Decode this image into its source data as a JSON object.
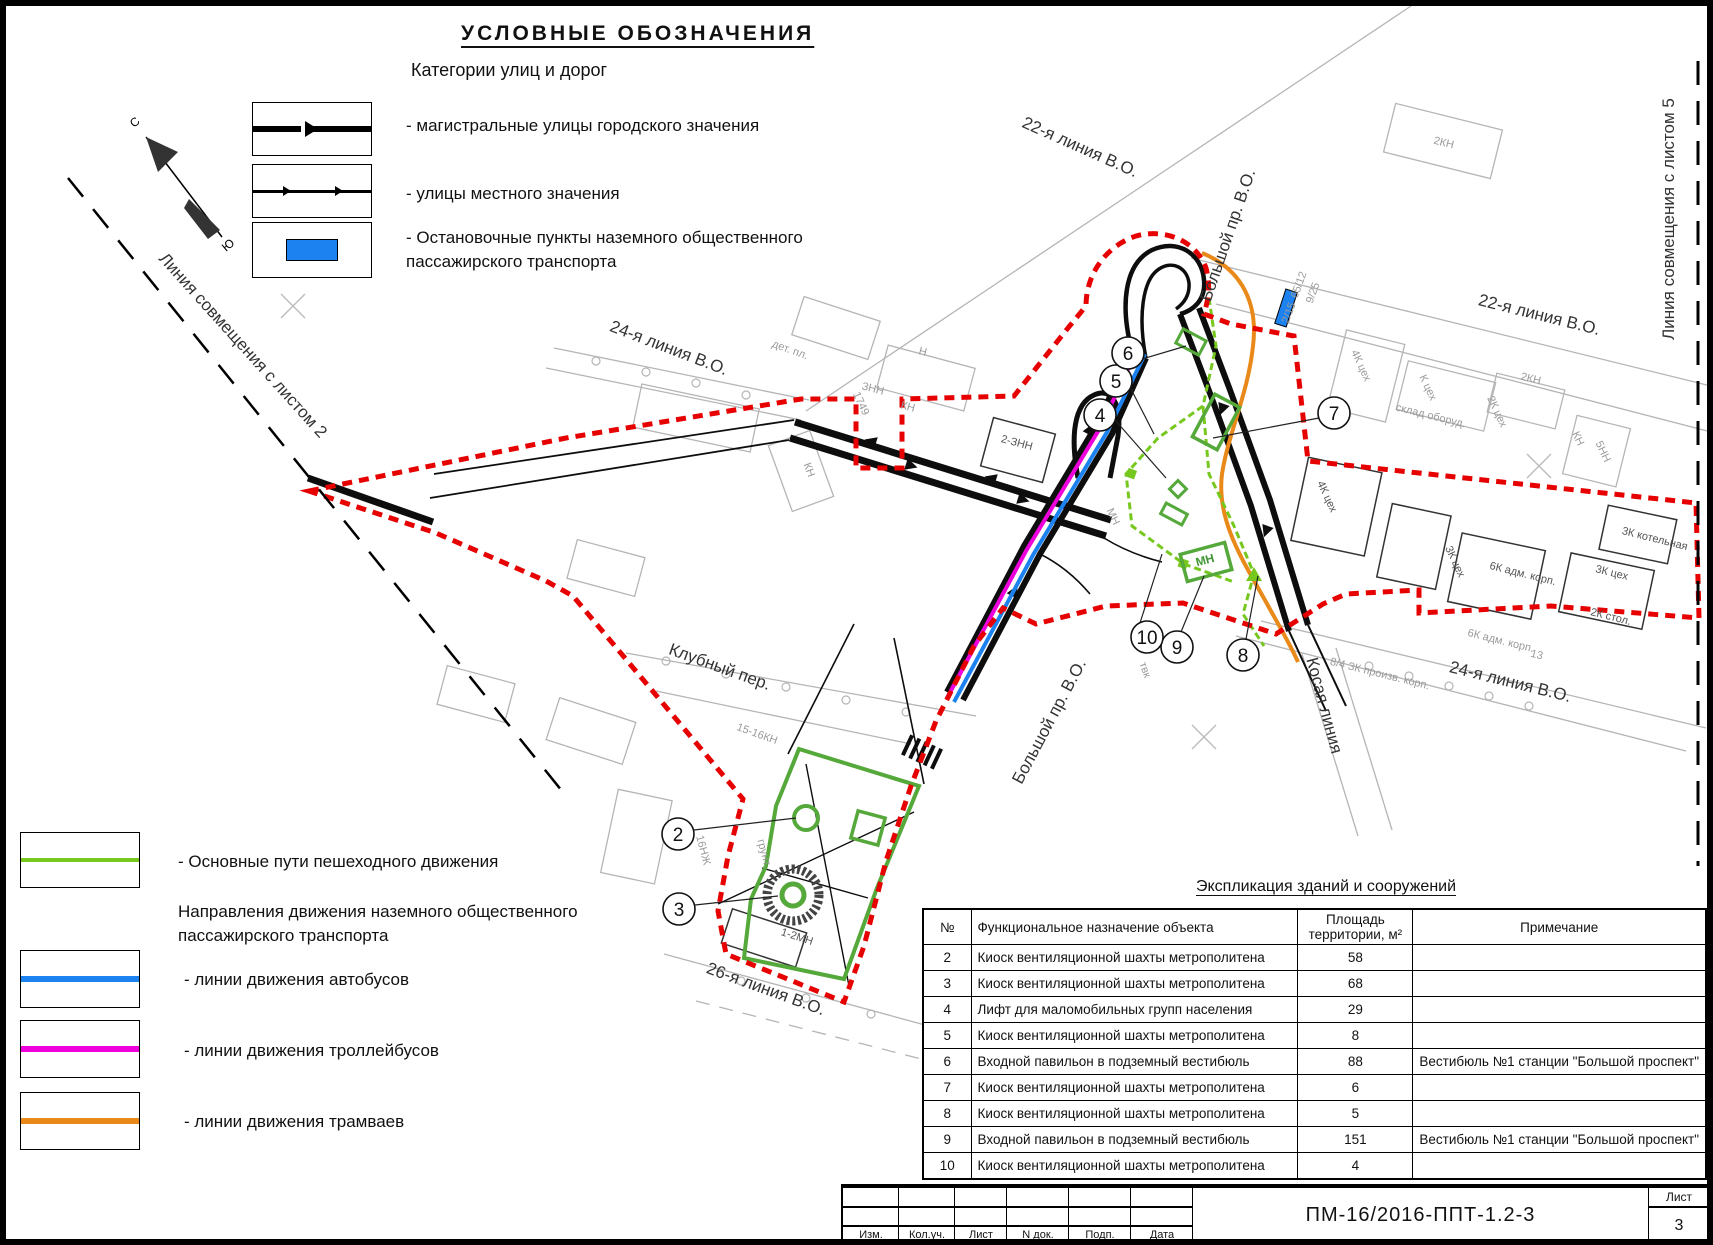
{
  "legend_top": {
    "title": "УСЛОВНЫЕ  ОБОЗНАЧЕНИЯ",
    "subtitle": "Категории улиц и дорог",
    "item_arterial": "-  магистральные улицы городского значения",
    "item_local": "-  улицы местного значения",
    "item_stops": "-  Остановочные пункты наземного общественного пассажирского транспорта"
  },
  "legend_bottom": {
    "pedestrian": "-  Основные пути пешеходного движения",
    "transport_header": "Направления движения наземного  общественного пассажирского транспорта",
    "buses": "-  линии движения автобусов",
    "trolleybuses": "-  линии движения троллейбусов",
    "trams": "-  линии движения трамваев"
  },
  "colors": {
    "bus": "#1c82f0",
    "trolleybus": "#ee00dd",
    "tram": "#e8891a",
    "pedestrian": "#76c81e",
    "park_green": "#55a83a",
    "boundary": "#e60000"
  },
  "map": {
    "north_n": "С",
    "north_s": "Ю",
    "markers": [
      "2",
      "3",
      "4",
      "5",
      "6",
      "7",
      "8",
      "9",
      "10"
    ],
    "street_labels": [
      {
        "text": "22-я линия В.О."
      },
      {
        "text": "Большой пр. В.О."
      },
      {
        "text": "22-я линия В.О."
      },
      {
        "text": "24-я линия В.О."
      },
      {
        "text": "Линия совмещения с листом 5"
      },
      {
        "text": "Линия совмещения с листом 2"
      },
      {
        "text": "Клубный пер."
      },
      {
        "text": "Большой пр. В.О."
      },
      {
        "text": "Косая линия"
      },
      {
        "text": "24-я линия В.О."
      },
      {
        "text": "26-я линия В.О."
      }
    ],
    "building_labels": [
      {
        "text": "дет. пл."
      },
      {
        "text": "Н"
      },
      {
        "text": "ЗНН"
      },
      {
        "text": "1749"
      },
      {
        "text": "КН"
      },
      {
        "text": "КН"
      },
      {
        "text": "2-ЗНН"
      },
      {
        "text": "65/12"
      },
      {
        "text": "9/25"
      },
      {
        "text": "2КН"
      },
      {
        "text": "4К цех"
      },
      {
        "text": "К цех"
      },
      {
        "text": "склад оборуд."
      },
      {
        "text": "2К цех"
      },
      {
        "text": "2КН"
      },
      {
        "text": "5НН"
      },
      {
        "text": "КН"
      },
      {
        "text": "4К цех"
      },
      {
        "text": "3К цех"
      },
      {
        "text": "6К адм. корп."
      },
      {
        "text": "3К котельная"
      },
      {
        "text": "3К цех"
      },
      {
        "text": "2К стол."
      },
      {
        "text": "6К адм. корп."
      },
      {
        "text": "8/4 ЗК произв. корп."
      },
      {
        "text": "13"
      },
      {
        "text": "15-16КН"
      },
      {
        "text": "16НЖ"
      },
      {
        "text": "грунт."
      },
      {
        "text": "1-2МН"
      },
      {
        "text": "МН"
      },
      {
        "text": "МН"
      },
      {
        "text": "твк"
      },
      {
        "text": "2/15"
      }
    ]
  },
  "table": {
    "title": "Экспликация зданий и сооружений",
    "headers": {
      "num": "№",
      "purpose": "Функциональное назначение объекта",
      "area_l1": "Площадь",
      "area_l2": "территории, м²",
      "note": "Примечание"
    },
    "rows": [
      {
        "n": "2",
        "p": "Киоск вентиляционной шахты метрополитена",
        "a": "58",
        "note": ""
      },
      {
        "n": "3",
        "p": "Киоск вентиляционной шахты метрополитена",
        "a": "68",
        "note": ""
      },
      {
        "n": "4",
        "p": "Лифт для маломобильных групп населения",
        "a": "29",
        "note": ""
      },
      {
        "n": "5",
        "p": "Киоск вентиляционной шахты метрополитена",
        "a": "8",
        "note": ""
      },
      {
        "n": "6",
        "p": "Входной павильон в подземный вестибюль",
        "a": "88",
        "note": "Вестибюль №1 станции \"Большой проспект\""
      },
      {
        "n": "7",
        "p": "Киоск вентиляционной шахты метрополитена",
        "a": "6",
        "note": ""
      },
      {
        "n": "8",
        "p": "Киоск вентиляционной шахты метрополитена",
        "a": "5",
        "note": ""
      },
      {
        "n": "9",
        "p": "Входной павильон в подземный вестибюль",
        "a": "151",
        "note": "Вестибюль №1 станции \"Большой проспект\""
      },
      {
        "n": "10",
        "p": "Киоск вентиляционной шахты метрополитена",
        "a": "4",
        "note": ""
      }
    ]
  },
  "title_block": {
    "code": "ПМ-16/2016-ППТ-1.2-3",
    "sheet_label": "Лист",
    "sheet_number": "3",
    "cols": [
      "Изм.",
      "Кол.уч.",
      "Лист",
      "N док.",
      "Подп.",
      "Дата"
    ]
  }
}
